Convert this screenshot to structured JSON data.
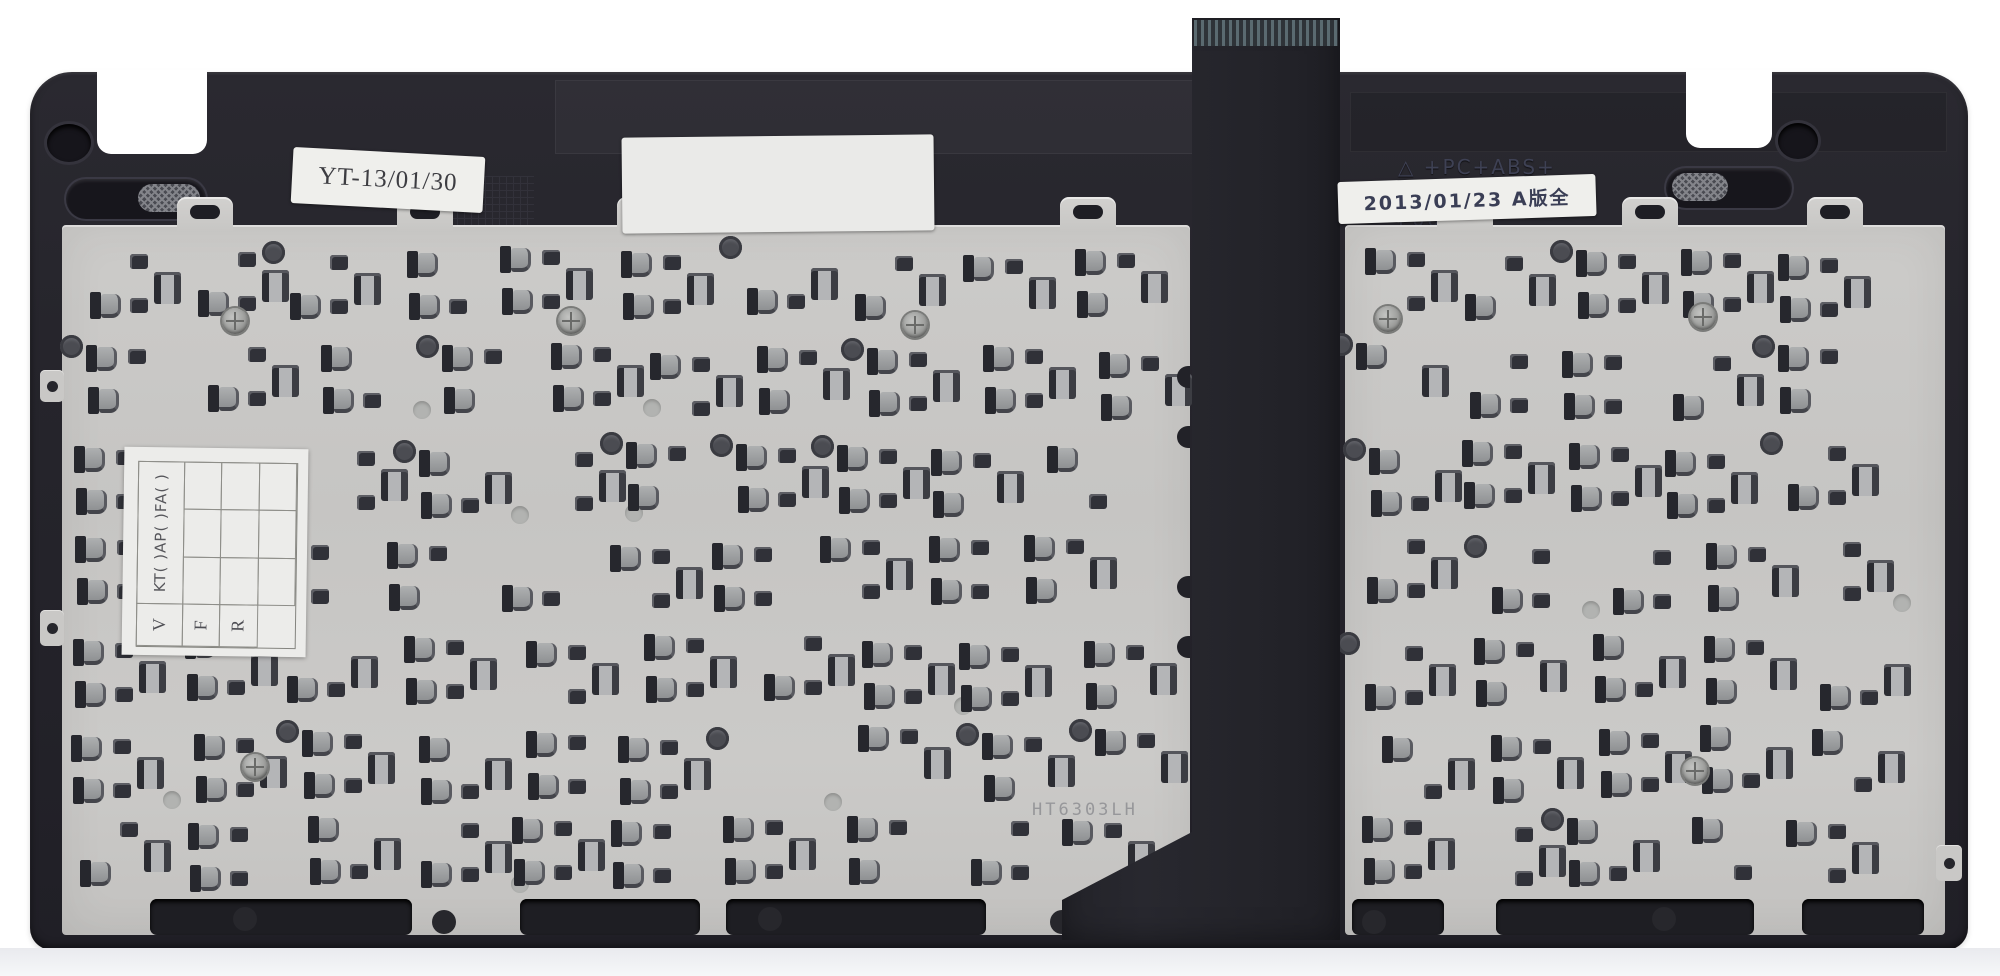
{
  "colors": {
    "background": "#ffffff",
    "frame": "#26252c",
    "plate": "#c8c7c5",
    "ribbon": "#232329",
    "ribbon_contacts": "#5a6a70",
    "hole_dark": "#303138",
    "sticker": "#efefec"
  },
  "stickers": {
    "handwritten": {
      "text": "YT-13/01/30"
    },
    "blank": {
      "text": ""
    },
    "revision": {
      "text": "2013/01/23 A版全"
    },
    "qc_grid": {
      "rotated_header": "KT( )AP( )FA( )",
      "row_labels": [
        "V",
        "F",
        "R"
      ]
    }
  },
  "frame_molded": {
    "symbol": "△",
    "line1": "+PC+ABS+",
    "line2": "LG-5001 KSLS v1",
    "line3": "P06X-1"
  },
  "plate": {
    "etched_code": "HT6303LH"
  }
}
